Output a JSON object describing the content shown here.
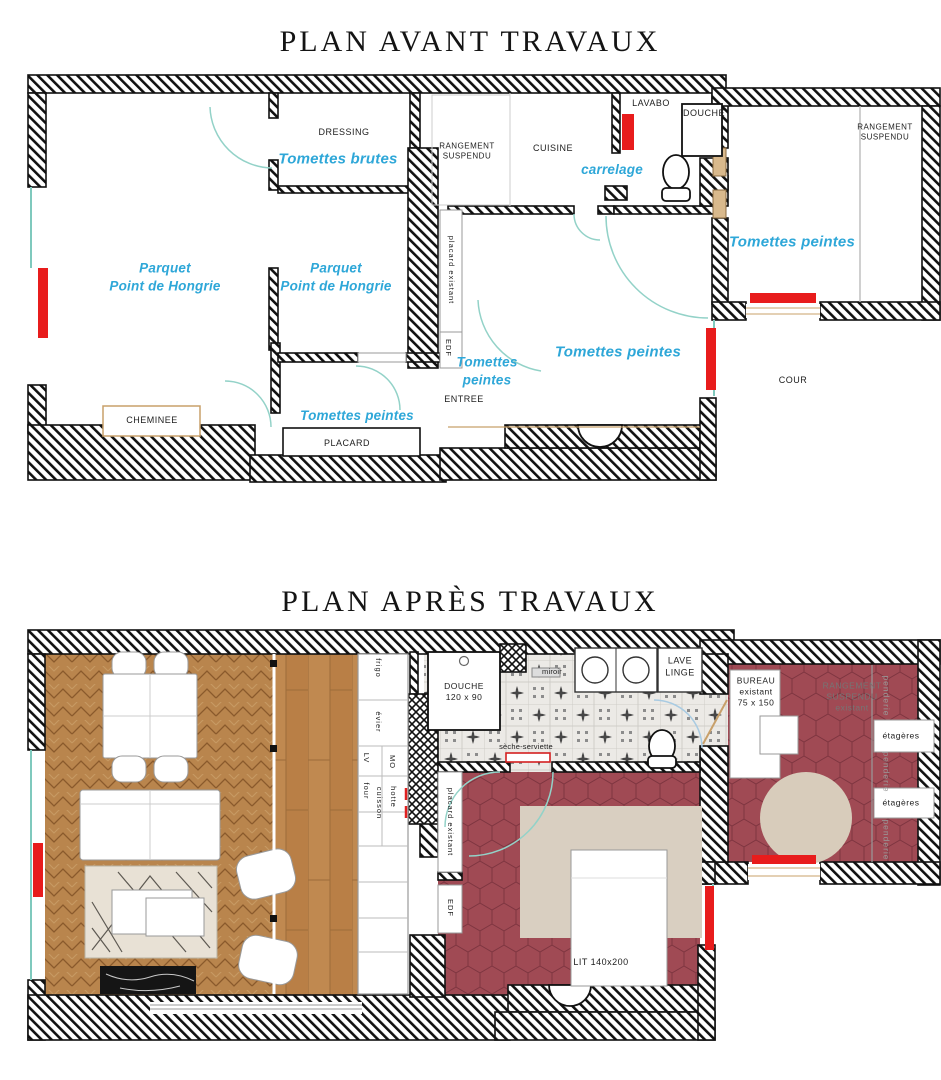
{
  "titles": {
    "before": "PLAN AVANT TRAVAUX",
    "after": "PLAN APRÈS TRAVAUX"
  },
  "colors": {
    "radiator_red": "#e81c1c",
    "floor_label_blue": "#2ea7d8",
    "hex_tile_red": "#a04a54",
    "door_arc_teal": "#93d2c8",
    "window_tan": "#c8a06a",
    "wall_hatch": "#111111"
  },
  "plan_before": {
    "labels": {
      "dressing": "DRESSING",
      "tomettes_brutes": "Tomettes brutes",
      "rangement_suspendu_left": "RANGEMENT\nSUSPENDU",
      "cuisine": "CUISINE",
      "carrelage": "carrelage",
      "lavabo": "LAVABO",
      "douche": "DOUCHE",
      "rangement_suspendu_right": "RANGEMENT\nSUSPENDU",
      "tomettes_peintes_right": "Tomettes peintes",
      "parquet_hongrie_1": "Parquet\nPoint de Hongrie",
      "parquet_hongrie_2": "Parquet\nPoint de Hongrie",
      "placard_existant": "placard existant",
      "edf": "EDF",
      "tomettes_peintes_entree_1": "Tomettes\npeintes",
      "tomettes_peintes_entree_2": "Tomettes peintes",
      "tomettes_peintes_room": "Tomettes peintes",
      "entree": "ENTREE",
      "cheminee": "CHEMINEE",
      "placard": "PLACARD",
      "cour": "COUR"
    }
  },
  "plan_after": {
    "labels": {
      "frigo": "frigo",
      "evier": "évier",
      "lv": "LV",
      "mo": "MO",
      "four": "four",
      "hotte": "hotte",
      "cuisson": "cuisson",
      "douche": "DOUCHE\n120 x 90",
      "miroir": "miroir",
      "lave_linge": "LAVE\nLINGE",
      "seche_serviette": "sèche-serviette",
      "placard_existant": "placard existant",
      "edf": "EDF",
      "lit": "LIT 140x200",
      "bureau": "BUREAU\nexistant\n75 x 150",
      "rangement_suspendu": "RANGEMENT\nSUSPENDU\nexistant",
      "penderie_1": "penderie",
      "penderie_2": "penderie",
      "penderie_3": "penderie",
      "etageres_1": "étagères",
      "etageres_2": "étagères"
    }
  }
}
